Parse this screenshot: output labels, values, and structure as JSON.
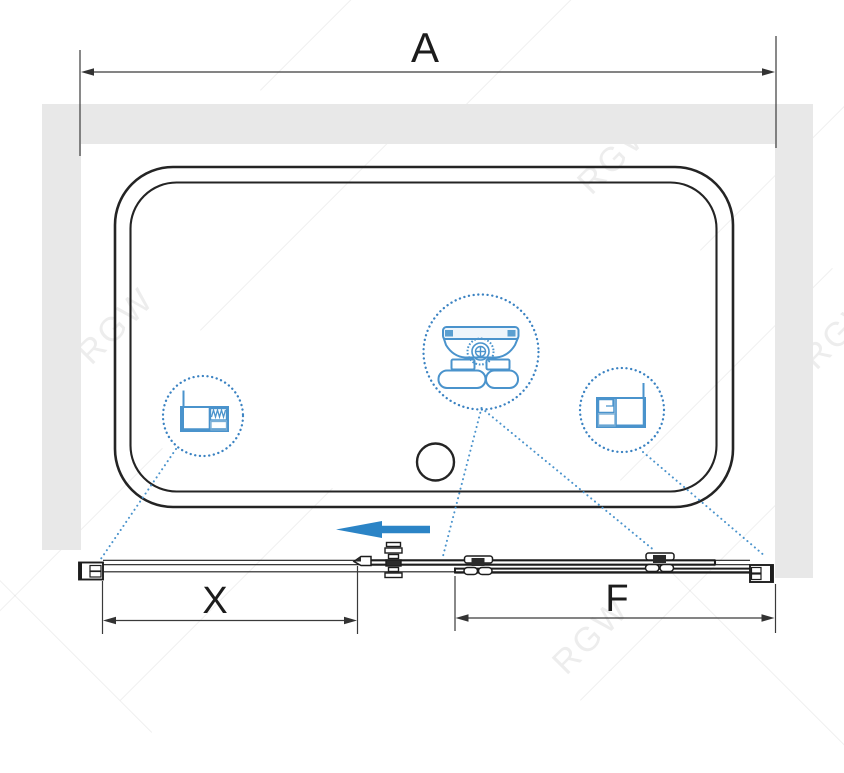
{
  "watermark": {
    "text": "RGW"
  },
  "dimensions": {
    "overall_width": {
      "label": "A"
    },
    "sliding_door": {
      "label": "X"
    },
    "fixed_panel": {
      "label": "F"
    }
  },
  "icons": {
    "left_detail": "wall-profile-cross-section-icon",
    "center_detail": "roller-carriage-icon",
    "right_detail": "panel-profile-cross-section-icon",
    "direction": "slide-direction-arrow-icon"
  },
  "colors": {
    "accent_blue": "#2b84c6",
    "detail_blue": "#4a93cc",
    "detail_blue_dark": "#5b9fd0",
    "detail_blue_light": "#eef5fb",
    "wall_gray": "#e8e8e8",
    "line_dark": "#222222",
    "dimension_line": "#3a3a3a"
  }
}
